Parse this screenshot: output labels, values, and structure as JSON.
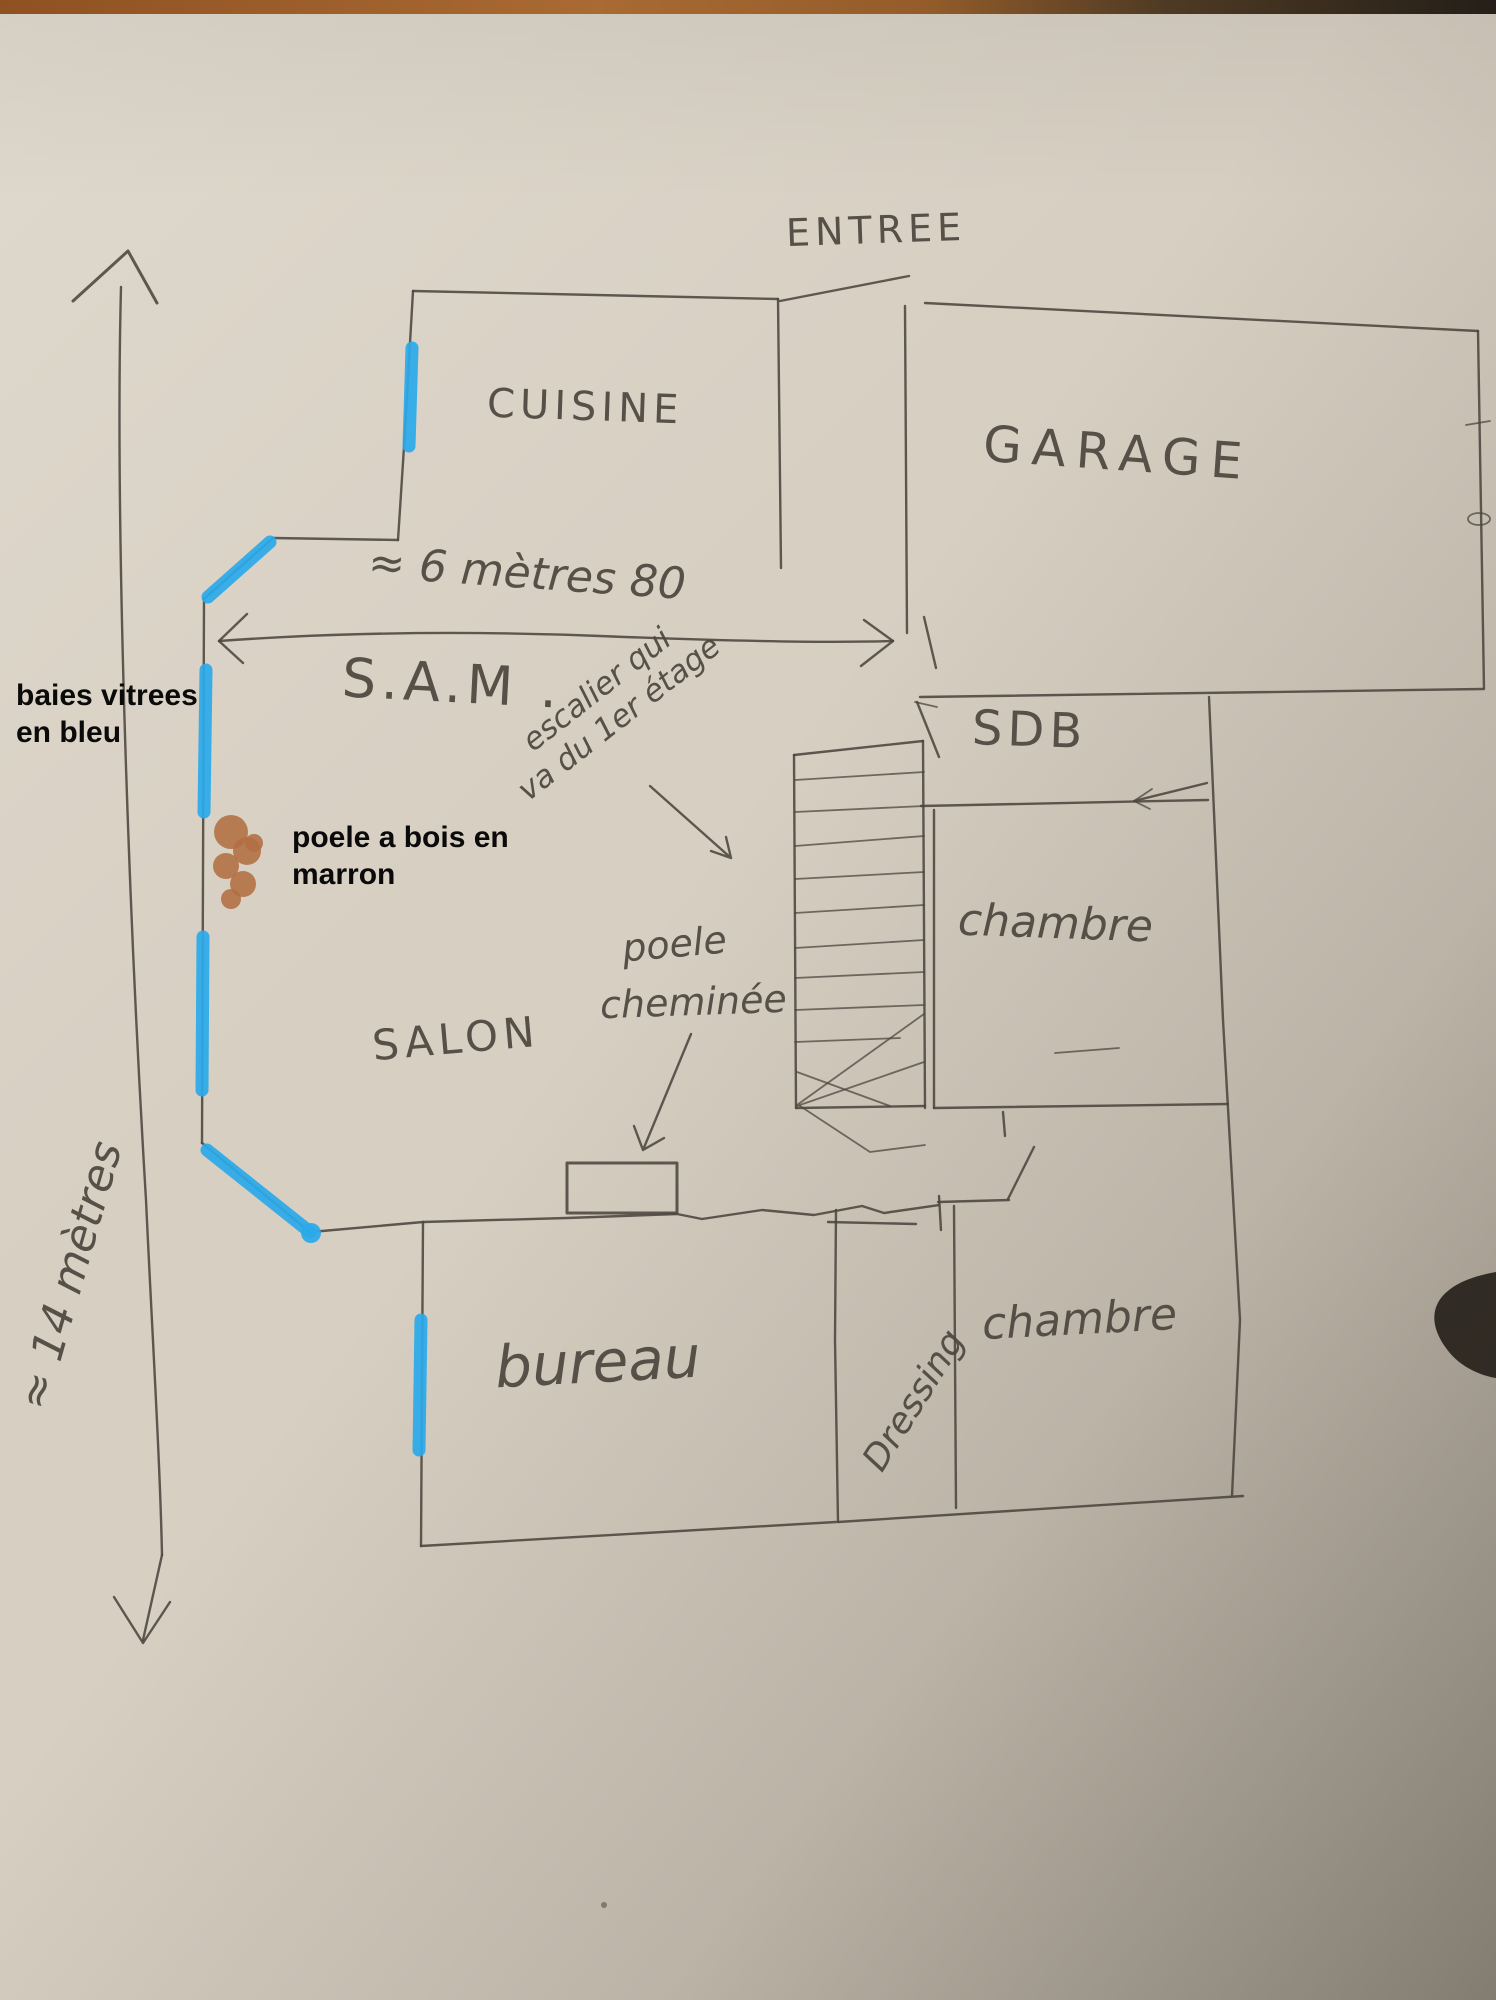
{
  "title": "hand-drawn house floor plan photo",
  "rooms": {
    "entree": {
      "label": "ENTREE"
    },
    "cuisine": {
      "label": "CUISINE"
    },
    "garage": {
      "label": "GARAGE"
    },
    "sam": {
      "label": "S.A.M ."
    },
    "sdb": {
      "label": "SDB"
    },
    "chambre_milieu": {
      "label": "chambre"
    },
    "salon": {
      "label": "SALON"
    },
    "bureau": {
      "label": "bureau"
    },
    "dressing": {
      "label": "Dressing"
    },
    "chambre_bas": {
      "label": "chambre"
    }
  },
  "notes": {
    "escalier_ligne1": "escalier qui",
    "escalier_ligne2": "va du 1er étage",
    "poele_ligne1": "poele",
    "poele_ligne2": "cheminée"
  },
  "measurements": {
    "largeur": "≈ 6 mètres 80",
    "longueur": "≈ 14 mètres"
  },
  "annotations": {
    "baies_ligne1": "baies vitrees",
    "baies_ligne2": "en bleu",
    "poele_ligne1": "poele a bois en",
    "poele_ligne2": "marron"
  },
  "colors": {
    "pencil": "#4c463f",
    "blue": "#2aa9ea",
    "brown": "#b26e42",
    "ink": "#0a0a0a",
    "paper": "#d7cfc2"
  }
}
